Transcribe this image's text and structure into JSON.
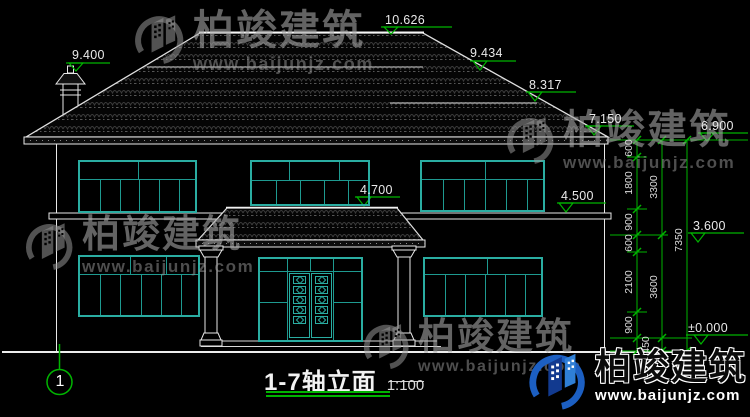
{
  "colors": {
    "background": "#000000",
    "line_white": "#e8e8e8",
    "dimension_green": "#00b400",
    "window_teal": "#2aada2",
    "watermark_gray": "#9a9a9a",
    "logo_blue": "#2f7fd6"
  },
  "title": {
    "name": "1-7轴立面",
    "scale": "1:100"
  },
  "axis": {
    "bubble": "1"
  },
  "elevations": {
    "ridge": "10.626",
    "chimney": "9.400",
    "upper_slope": "9.434",
    "wing_ridge": "8.317",
    "eave_right": "7.150",
    "wall_top": "6.900",
    "porch_canopy": "4.700",
    "floor2_band": "4.500",
    "floor2_level": "3.600",
    "ground_level": "±0.000"
  },
  "dimensions": {
    "inner_chain": [
      "600",
      "1800",
      "900",
      "600",
      "2100",
      "900"
    ],
    "base_offset": "450",
    "mid_chain": [
      "3300",
      "3600"
    ],
    "total": "7350"
  },
  "watermark": {
    "brand": "柏竣建筑",
    "url": "www.baijunjz.com",
    "logo_icon": "building-swoosh-logo"
  }
}
